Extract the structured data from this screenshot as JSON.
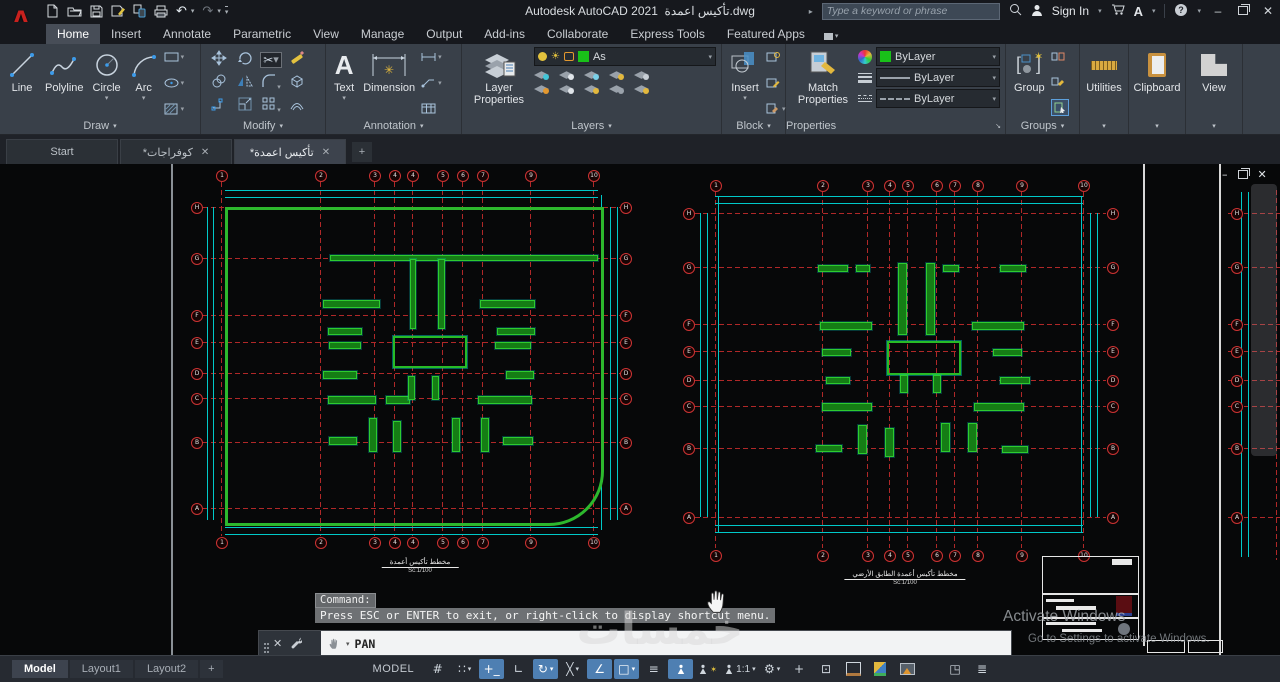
{
  "theme": {
    "accent_blue": "#4e7fb2",
    "ribbon_bg": "#394049",
    "titlebar_bg": "#16181d",
    "canvas_bg": "#070809",
    "cad_green": "#2db82d",
    "cad_red": "#b02828",
    "cad_cyan": "#00c9c9",
    "bylayer_green": "#19c119"
  },
  "titlebar": {
    "app": "Autodesk AutoCAD 2021",
    "doc": "تأكيس اعمدة.dwg",
    "search_placeholder": "Type a keyword or phrase",
    "sign_in": "Sign In",
    "qat": [
      "new",
      "open",
      "save",
      "save-as",
      "open-web-mobile",
      "plot",
      "undo",
      "redo",
      "customize"
    ],
    "window": [
      "minimize",
      "restore",
      "close"
    ]
  },
  "ribbon_tabs": [
    {
      "label": "Home",
      "active": true
    },
    {
      "label": "Insert"
    },
    {
      "label": "Annotate"
    },
    {
      "label": "Parametric"
    },
    {
      "label": "View"
    },
    {
      "label": "Manage"
    },
    {
      "label": "Output"
    },
    {
      "label": "Add-ins"
    },
    {
      "label": "Collaborate"
    },
    {
      "label": "Express Tools"
    },
    {
      "label": "Featured Apps"
    }
  ],
  "ribbon": {
    "draw": {
      "title": "Draw",
      "line": "Line",
      "polyline": "Polyline",
      "circle": "Circle",
      "arc": "Arc"
    },
    "modify": {
      "title": "Modify",
      "tools": [
        "move",
        "rotate",
        "trim",
        "erase",
        "copy",
        "mirror",
        "fillet",
        "explode",
        "stretch",
        "scale",
        "array",
        "offset"
      ]
    },
    "annotation": {
      "title": "Annotation",
      "text": "Text",
      "dimension": "Dimension"
    },
    "layers": {
      "title": "Layers",
      "big": "Layer Properties",
      "combo_value": "As",
      "tools": [
        "off",
        "isolate",
        "freeze",
        "lock",
        "merge",
        "make-current",
        "match-layer",
        "previous",
        "lock-fade",
        "copy-to-layer"
      ]
    },
    "block": {
      "title": "Block",
      "big": "Insert",
      "tools": [
        "create-block",
        "edit-attribute",
        "block-editor"
      ]
    },
    "properties": {
      "title": "Properties",
      "big": "Match Properties",
      "color": "ByLayer",
      "lineweight": "ByLayer",
      "linetype": "ByLayer"
    },
    "groups": {
      "title": "Groups",
      "big": "Group",
      "tools": [
        "ungroup",
        "group-edit",
        "group-selection-on"
      ]
    },
    "utilities": {
      "big": "Utilities"
    },
    "clipboard": {
      "big": "Clipboard"
    },
    "view": {
      "big": "View"
    }
  },
  "file_tabs": [
    {
      "label": "Start",
      "active": false,
      "closable": false
    },
    {
      "label": "*كوفراجات",
      "active": false,
      "closable": true
    },
    {
      "label": "*تأكيس اعمدة",
      "active": true,
      "closable": true
    }
  ],
  "command_overlay": {
    "prompt": "Command:",
    "message": "Press ESC or ENTER to exit, or right-click to display shortcut menu."
  },
  "command_dock": {
    "command": "PAN"
  },
  "status_bar": {
    "layout_tabs": [
      {
        "label": "Model",
        "active": true
      },
      {
        "label": "Layout1"
      },
      {
        "label": "Layout2"
      }
    ],
    "model_label": "MODEL",
    "icons": [
      {
        "name": "grid-display",
        "glyph": "#",
        "on": false
      },
      {
        "name": "snap-mode",
        "glyph": "∷",
        "dd": true
      },
      {
        "name": "dynamic-input",
        "glyph": "+_",
        "on": true
      },
      {
        "name": "ortho-mode",
        "glyph": "∟"
      },
      {
        "name": "polar-tracking",
        "glyph": "↻",
        "on": true,
        "dd": true
      },
      {
        "name": "isometric-drafting",
        "glyph": "╳",
        "dd": true
      },
      {
        "name": "object-snap-tracking",
        "glyph": "∠",
        "on": true
      },
      {
        "name": "object-snap",
        "glyph": "□",
        "on": true,
        "dd": true
      },
      {
        "name": "lineweight-display",
        "glyph": "≡"
      },
      {
        "name": "annotation-visibility",
        "type": "person",
        "on": true
      },
      {
        "name": "annotation-autoscale",
        "type": "person-star"
      },
      {
        "name": "annotation-scale",
        "type": "person",
        "label": "1:1",
        "dd": true
      },
      {
        "name": "workspace-switching",
        "glyph": "⚙",
        "dd": true
      },
      {
        "name": "annotation-monitor",
        "glyph": "+"
      },
      {
        "name": "quick-properties",
        "glyph": "⊡"
      },
      {
        "name": "plot",
        "type": "printer"
      },
      {
        "name": "graphics-performance",
        "type": "gpu"
      },
      {
        "name": "hardware-acceleration",
        "type": "img"
      },
      {
        "name": "clean-screen",
        "glyph": "◳",
        "gap": true
      },
      {
        "name": "customization",
        "glyph": "≣"
      }
    ]
  },
  "watermarks": {
    "khamsat": "خمسات",
    "activate_line1": "Activate Windows",
    "activate_line2": "Go to Settings to activate Windows."
  },
  "canvas": {
    "window_controls": [
      "minimize",
      "restore",
      "close"
    ],
    "plans": [
      {
        "name": "plan-basement",
        "frame": {
          "x": 225,
          "y": 207,
          "w": 373,
          "h": 313,
          "br_radius": 55
        },
        "v": {
          "y0": 182,
          "y1": 536,
          "top_b": 175,
          "bot_b": 542,
          "lines": [
            {
              "x": 221,
              "l": "1"
            },
            {
              "x": 320,
              "l": "2"
            },
            {
              "x": 374,
              "l": "3"
            },
            {
              "x": 394,
              "l": "4"
            },
            {
              "x": 412,
              "l": "4"
            },
            {
              "x": 442,
              "l": "5"
            },
            {
              "x": 462,
              "l": "6"
            },
            {
              "x": 482,
              "l": "7"
            },
            {
              "x": 530,
              "l": "9"
            },
            {
              "x": 593,
              "l": "10"
            }
          ]
        },
        "h": {
          "x0": 203,
          "x1": 620,
          "left_b": 196,
          "right_b": 625,
          "lines": [
            {
              "y": 207,
              "l": "H"
            },
            {
              "y": 258,
              "l": "G"
            },
            {
              "y": 315,
              "l": "F"
            },
            {
              "y": 342,
              "l": "E"
            },
            {
              "y": 373,
              "l": "D"
            },
            {
              "y": 398,
              "l": "C"
            },
            {
              "y": 442,
              "l": "B"
            },
            {
              "y": 508,
              "l": "A"
            }
          ]
        },
        "cyan_h": [
          {
            "y": 190,
            "x0": 225,
            "x1": 598
          },
          {
            "y": 197,
            "x0": 225,
            "x1": 598
          },
          {
            "y": 527,
            "x0": 225,
            "x1": 598
          },
          {
            "y": 534,
            "x0": 225,
            "x1": 598
          }
        ],
        "cyan_v": [
          {
            "x": 207,
            "y0": 207,
            "y1": 520
          },
          {
            "x": 213,
            "y0": 207,
            "y1": 520
          },
          {
            "x": 610,
            "y0": 207,
            "y1": 520
          },
          {
            "x": 617,
            "y0": 207,
            "y1": 520
          },
          {
            "x": 601,
            "y0": 195,
            "y1": 530
          }
        ],
        "core": {
          "x": 393,
          "y": 336,
          "w": 70,
          "h": 28
        },
        "bars": [
          {
            "x": 330,
            "y": 255,
            "w": 266,
            "h": 4
          },
          {
            "x": 410,
            "y": 259,
            "w": 4,
            "h": 68
          },
          {
            "x": 438,
            "y": 259,
            "w": 5,
            "h": 68
          },
          {
            "x": 323,
            "y": 300,
            "w": 55,
            "h": 6
          },
          {
            "x": 480,
            "y": 300,
            "w": 53,
            "h": 6
          },
          {
            "x": 328,
            "y": 328,
            "w": 32,
            "h": 5
          },
          {
            "x": 497,
            "y": 328,
            "w": 36,
            "h": 5
          },
          {
            "x": 329,
            "y": 342,
            "w": 30,
            "h": 5
          },
          {
            "x": 495,
            "y": 342,
            "w": 34,
            "h": 5
          },
          {
            "x": 323,
            "y": 371,
            "w": 32,
            "h": 6
          },
          {
            "x": 506,
            "y": 371,
            "w": 26,
            "h": 6
          },
          {
            "x": 328,
            "y": 396,
            "w": 46,
            "h": 6
          },
          {
            "x": 386,
            "y": 396,
            "w": 22,
            "h": 6
          },
          {
            "x": 478,
            "y": 396,
            "w": 52,
            "h": 6
          },
          {
            "x": 408,
            "y": 376,
            "w": 5,
            "h": 22
          },
          {
            "x": 432,
            "y": 376,
            "w": 5,
            "h": 22
          },
          {
            "x": 369,
            "y": 418,
            "w": 6,
            "h": 32
          },
          {
            "x": 393,
            "y": 421,
            "w": 6,
            "h": 29
          },
          {
            "x": 452,
            "y": 418,
            "w": 6,
            "h": 32
          },
          {
            "x": 481,
            "y": 418,
            "w": 6,
            "h": 32
          },
          {
            "x": 329,
            "y": 437,
            "w": 26,
            "h": 6
          },
          {
            "x": 503,
            "y": 437,
            "w": 28,
            "h": 6
          }
        ],
        "caption": {
          "x": 420,
          "y": 558,
          "line1": "مخطط تأكيس أعمدة",
          "line2": "Sc:1/100"
        }
      },
      {
        "name": "plan-ground-floor",
        "frame": null,
        "v": {
          "y0": 192,
          "y1": 548,
          "top_b": 185,
          "bot_b": 555,
          "lines": [
            {
              "x": 715,
              "l": "1"
            },
            {
              "x": 822,
              "l": "2"
            },
            {
              "x": 867,
              "l": "3"
            },
            {
              "x": 889,
              "l": "4"
            },
            {
              "x": 907,
              "l": "5"
            },
            {
              "x": 936,
              "l": "6"
            },
            {
              "x": 954,
              "l": "7"
            },
            {
              "x": 977,
              "l": "8"
            },
            {
              "x": 1021,
              "l": "9"
            },
            {
              "x": 1083,
              "l": "10"
            }
          ]
        },
        "h": {
          "x0": 695,
          "x1": 1106,
          "left_b": 688,
          "right_b": 1112,
          "lines": [
            {
              "y": 213,
              "l": "H"
            },
            {
              "y": 267,
              "l": "G"
            },
            {
              "y": 324,
              "l": "F"
            },
            {
              "y": 351,
              "l": "E"
            },
            {
              "y": 380,
              "l": "D"
            },
            {
              "y": 406,
              "l": "C"
            },
            {
              "y": 448,
              "l": "B"
            },
            {
              "y": 517,
              "l": "A"
            }
          ]
        },
        "cyan_h": [
          {
            "y": 196,
            "x0": 715,
            "x1": 1083
          },
          {
            "y": 203,
            "x0": 715,
            "x1": 1083
          },
          {
            "y": 525,
            "x0": 715,
            "x1": 1083
          },
          {
            "y": 532,
            "x0": 715,
            "x1": 1083
          }
        ],
        "cyan_v": [
          {
            "x": 700,
            "y0": 213,
            "y1": 517
          },
          {
            "x": 707,
            "y0": 213,
            "y1": 517
          },
          {
            "x": 1090,
            "y0": 213,
            "y1": 517
          },
          {
            "x": 1097,
            "y0": 213,
            "y1": 517
          },
          {
            "x": 718,
            "y0": 196,
            "y1": 532
          },
          {
            "x": 1081,
            "y0": 196,
            "y1": 532
          }
        ],
        "core": {
          "x": 887,
          "y": 341,
          "w": 70,
          "h": 30
        },
        "bars": [
          {
            "x": 898,
            "y": 263,
            "w": 7,
            "h": 70
          },
          {
            "x": 926,
            "y": 263,
            "w": 7,
            "h": 70
          },
          {
            "x": 818,
            "y": 265,
            "w": 28,
            "h": 5
          },
          {
            "x": 856,
            "y": 265,
            "w": 12,
            "h": 5
          },
          {
            "x": 943,
            "y": 265,
            "w": 14,
            "h": 5
          },
          {
            "x": 1000,
            "y": 265,
            "w": 24,
            "h": 5
          },
          {
            "x": 820,
            "y": 322,
            "w": 50,
            "h": 6
          },
          {
            "x": 972,
            "y": 322,
            "w": 50,
            "h": 6
          },
          {
            "x": 822,
            "y": 349,
            "w": 27,
            "h": 5
          },
          {
            "x": 993,
            "y": 349,
            "w": 27,
            "h": 5
          },
          {
            "x": 826,
            "y": 377,
            "w": 22,
            "h": 5
          },
          {
            "x": 1000,
            "y": 377,
            "w": 28,
            "h": 5
          },
          {
            "x": 822,
            "y": 403,
            "w": 48,
            "h": 6
          },
          {
            "x": 974,
            "y": 403,
            "w": 48,
            "h": 6
          },
          {
            "x": 900,
            "y": 375,
            "w": 6,
            "h": 16
          },
          {
            "x": 933,
            "y": 375,
            "w": 6,
            "h": 16
          },
          {
            "x": 858,
            "y": 425,
            "w": 7,
            "h": 27
          },
          {
            "x": 885,
            "y": 428,
            "w": 7,
            "h": 27
          },
          {
            "x": 941,
            "y": 423,
            "w": 7,
            "h": 27
          },
          {
            "x": 968,
            "y": 423,
            "w": 7,
            "h": 27
          },
          {
            "x": 816,
            "y": 445,
            "w": 24,
            "h": 5
          },
          {
            "x": 1002,
            "y": 446,
            "w": 24,
            "h": 5
          }
        ],
        "caption": {
          "x": 905,
          "y": 570,
          "line1": "مخطط تأكيس أعمدة الطابق الأرضي",
          "line2": "Sc:1/100"
        }
      }
    ],
    "fragment": {
      "x0": 1228,
      "x1": 1280,
      "bub_x": 1236,
      "cyan_v": [
        1241,
        1248
      ],
      "red_v": 1276,
      "h_lines": [
        {
          "y": 213,
          "l": "H"
        },
        {
          "y": 267,
          "l": "G"
        },
        {
          "y": 324,
          "l": "F"
        },
        {
          "y": 351,
          "l": "E"
        },
        {
          "y": 380,
          "l": "D"
        },
        {
          "y": 406,
          "l": "C"
        },
        {
          "y": 448,
          "l": "B"
        },
        {
          "y": 517,
          "l": "A"
        }
      ]
    }
  }
}
